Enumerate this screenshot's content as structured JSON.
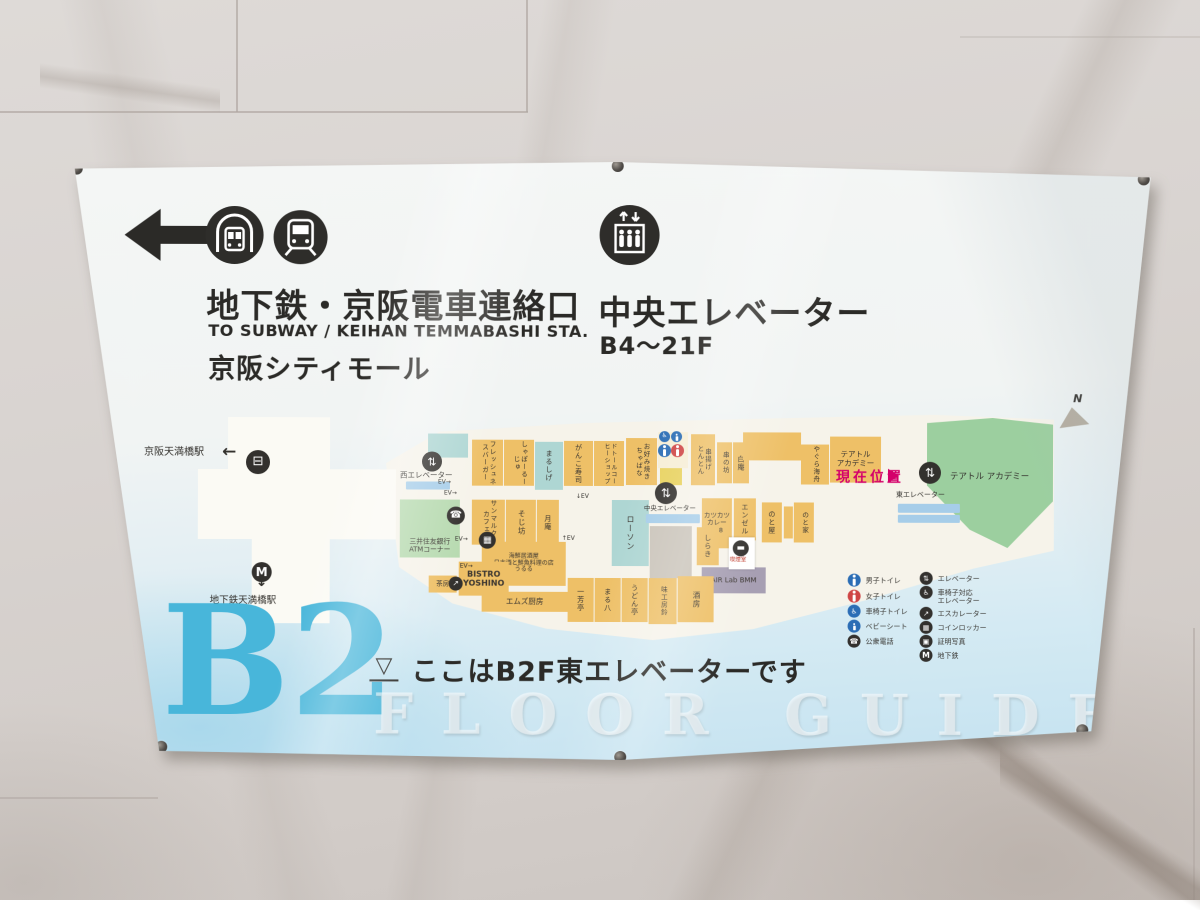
{
  "header": {
    "left": {
      "title": "地下鉄・京阪電車連絡口",
      "subtitle": "TO SUBWAY / KEIHAN TEMMABASHI STA.",
      "mall": "京阪シティモール"
    },
    "center": {
      "title": "中央エレベーター",
      "floors": "B4〜21F"
    }
  },
  "band": {
    "floor": "B2",
    "marker": "▽",
    "you_are_here": "ここはB2F東エレベーターです",
    "watermark": "FLOOR GUIDE"
  },
  "map": {
    "north_label": "N",
    "current_location": "現在位置",
    "colors": {
      "o": "#eec067",
      "t": "#aed6d3",
      "g": "#b7dab0",
      "G": "#9ccf9f",
      "gr": "#cac4ba",
      "p": "#a79fb3",
      "y": "#e8d25f",
      "c": "#f6eed6",
      "w": "#ffffff"
    },
    "corridors": [
      {
        "x": 158,
        "y": 258,
        "w": 70,
        "h": 54
      },
      {
        "x": 182,
        "y": 258,
        "w": 78,
        "h": 206
      },
      {
        "x": 128,
        "y": 310,
        "w": 198,
        "h": 70
      },
      {
        "x": 258,
        "y": 318,
        "w": 64,
        "h": 44
      }
    ],
    "blocks": [
      {
        "x": 402,
        "y": 280,
        "w": 31,
        "h": 46,
        "c": "o",
        "t": "フレッシュネスバーガー",
        "m": "v",
        "fs": 6.5,
        "n": "block-freshness-burger"
      },
      {
        "x": 434,
        "y": 280,
        "w": 30,
        "h": 46,
        "c": "o",
        "t": "しゃぽーるーじゅ",
        "m": "v",
        "fs": 6.5,
        "n": "block-chapeau-rouge"
      },
      {
        "x": 465,
        "y": 282,
        "w": 28,
        "h": 48,
        "c": "t",
        "t": "まるしげ",
        "m": "v",
        "fs": 7,
        "n": "block-marushige"
      },
      {
        "x": 494,
        "y": 281,
        "w": 29,
        "h": 45,
        "c": "o",
        "t": "がんこ寿司",
        "m": "v",
        "fs": 7,
        "n": "block-ganko-sushi"
      },
      {
        "x": 524,
        "y": 281,
        "w": 30,
        "h": 45,
        "c": "o",
        "t": "ドトールコーヒーショップ",
        "m": "v",
        "fs": 6,
        "n": "block-doutor-coffee"
      },
      {
        "x": 556,
        "y": 278,
        "w": 31,
        "h": 47,
        "c": "o",
        "t": "お好み焼き\nちゃばな",
        "m": "v",
        "fs": 6.5,
        "n": "block-okonomiyaki-chabana"
      },
      {
        "x": 588,
        "y": 272,
        "w": 30,
        "h": 36,
        "c": "c",
        "t": "",
        "n": "block-restroom-area"
      },
      {
        "x": 590,
        "y": 308,
        "w": 22,
        "h": 17,
        "c": "y",
        "t": "",
        "n": "block-service"
      },
      {
        "x": 621,
        "y": 274,
        "w": 24,
        "h": 51,
        "c": "o",
        "t": "串揚げ\nとんとん",
        "m": "v",
        "fs": 6.5,
        "n": "block-kushiage-tonton"
      },
      {
        "x": 647,
        "y": 282,
        "w": 15,
        "h": 41,
        "c": "o",
        "t": "串の坊",
        "m": "v",
        "fs": 6.5,
        "n": "block-kushinobo"
      },
      {
        "x": 663,
        "y": 282,
        "w": 16,
        "h": 41,
        "c": "o",
        "t": "白庵",
        "m": "v",
        "fs": 7,
        "n": "block-hakuan"
      },
      {
        "x": 673,
        "y": 272,
        "w": 58,
        "h": 28,
        "c": "o",
        "t": "",
        "n": "block-unlabeled-1"
      },
      {
        "x": 731,
        "y": 284,
        "w": 28,
        "h": 40,
        "c": "o",
        "t": "やぐら海舟",
        "m": "v",
        "fs": 6.5,
        "n": "block-yagura-kaishu"
      },
      {
        "x": 760,
        "y": 276,
        "w": 51,
        "h": 46,
        "c": "o",
        "t": "テアトル\nアカデミー",
        "m": "h",
        "fs": 7.5,
        "n": "block-theatre-academy-room"
      },
      {
        "x": 402,
        "y": 340,
        "w": 33,
        "h": 45,
        "c": "o",
        "t": "サンマルク・カフェ",
        "m": "v",
        "fs": 6.5,
        "n": "block-saint-marc-cafe"
      },
      {
        "x": 436,
        "y": 340,
        "w": 30,
        "h": 45,
        "c": "o",
        "t": "そじ坊",
        "m": "v",
        "fs": 7.5,
        "n": "block-sojibo"
      },
      {
        "x": 467,
        "y": 340,
        "w": 22,
        "h": 45,
        "c": "o",
        "t": "月庵",
        "m": "v",
        "fs": 7,
        "n": "block-tsukian"
      },
      {
        "x": 542,
        "y": 340,
        "w": 37,
        "h": 66,
        "c": "t",
        "t": "ローソン",
        "m": "v",
        "fs": 8,
        "n": "block-lawson"
      },
      {
        "x": 580,
        "y": 366,
        "w": 42,
        "h": 52,
        "c": "gr",
        "t": "",
        "n": "block-backroom"
      },
      {
        "x": 632,
        "y": 338,
        "w": 30,
        "h": 50,
        "c": "o",
        "t": "カツカツ\nカレー888",
        "m": "h",
        "fs": 6.5,
        "n": "block-katsukatsu-curry"
      },
      {
        "x": 664,
        "y": 338,
        "w": 22,
        "h": 42,
        "c": "o",
        "t": "エンゼル",
        "m": "v",
        "fs": 7,
        "n": "block-angel"
      },
      {
        "x": 692,
        "y": 342,
        "w": 20,
        "h": 40,
        "c": "o",
        "t": "のと屋",
        "m": "v",
        "fs": 7,
        "n": "block-notoya"
      },
      {
        "x": 714,
        "y": 346,
        "w": 9,
        "h": 32,
        "c": "o",
        "t": "",
        "n": "block-unlabeled-2"
      },
      {
        "x": 724,
        "y": 342,
        "w": 20,
        "h": 40,
        "c": "o",
        "t": "のと家",
        "m": "v",
        "fs": 6.5,
        "n": "block-notoke"
      },
      {
        "x": 627,
        "y": 367,
        "w": 22,
        "h": 38,
        "c": "o",
        "t": "しらき",
        "m": "v",
        "fs": 7,
        "n": "block-shiraki"
      },
      {
        "x": 632,
        "y": 407,
        "w": 64,
        "h": 26,
        "c": "p",
        "t": "AIR Lab BMM",
        "m": "h",
        "fs": 7,
        "n": "block-air-lab"
      },
      {
        "x": 412,
        "y": 382,
        "w": 84,
        "h": 44,
        "c": "o",
        "t": "海鮮居酒屋\n日本酒と鮮魚料理の店\nうるる",
        "m": "h",
        "fs": 6,
        "n": "block-ururu"
      },
      {
        "x": 389,
        "y": 402,
        "w": 50,
        "h": 34,
        "c": "o",
        "t": "BISTRO\nYOSHINO",
        "m": "h",
        "fs": 8,
        "b": 1,
        "n": "block-bistro-yoshino"
      },
      {
        "x": 359,
        "y": 416,
        "w": 28,
        "h": 17,
        "c": "o",
        "t": "茶房",
        "m": "h",
        "fs": 6.5,
        "n": "block-sabo"
      },
      {
        "x": 412,
        "y": 432,
        "w": 86,
        "h": 20,
        "c": "o",
        "t": "エムズ厨房",
        "m": "h",
        "fs": 7.5,
        "n": "block-ms-kitchen"
      },
      {
        "x": 498,
        "y": 418,
        "w": 26,
        "h": 44,
        "c": "o",
        "t": "一芳亭",
        "m": "v",
        "fs": 7,
        "n": "block-ippotei"
      },
      {
        "x": 525,
        "y": 418,
        "w": 26,
        "h": 44,
        "c": "o",
        "t": "まる八",
        "m": "v",
        "fs": 7,
        "n": "block-maruhachi"
      },
      {
        "x": 552,
        "y": 418,
        "w": 26,
        "h": 44,
        "c": "o",
        "t": "うどん亭",
        "m": "v",
        "fs": 7,
        "n": "block-udontei"
      },
      {
        "x": 579,
        "y": 418,
        "w": 28,
        "h": 46,
        "c": "o",
        "t": "味工房鈴",
        "m": "v",
        "fs": 6.5,
        "n": "block-ajikobo-suzu"
      },
      {
        "x": 608,
        "y": 416,
        "w": 36,
        "h": 46,
        "c": "o",
        "t": "酒房",
        "m": "v",
        "fs": 7.5,
        "n": "block-shubo"
      },
      {
        "x": 358,
        "y": 274,
        "w": 40,
        "h": 24,
        "c": "t",
        "t": "",
        "n": "block-unlabeled-3"
      },
      {
        "x": 330,
        "y": 340,
        "w": 60,
        "h": 58,
        "c": "g",
        "t": "三井住友銀行\nATMコーナー",
        "m": "h",
        "fs": 6.8,
        "va": "end",
        "n": "block-smbc-atm"
      },
      {
        "x": 659,
        "y": 377,
        "w": 26,
        "h": 32,
        "c": "w",
        "t": "",
        "n": "block-smoking-room"
      }
    ],
    "icons": [
      {
        "x": 176,
        "y": 291,
        "d": 24,
        "bg": "#33312e",
        "g": "train",
        "n": "keihan-station-icon"
      },
      {
        "x": 182,
        "y": 403,
        "d": 20,
        "bg": "#33312e",
        "g": "subway",
        "n": "subway-station-icon"
      },
      {
        "x": 352,
        "y": 292,
        "d": 20,
        "bg": "#33312e",
        "g": "ev",
        "n": "west-elevator-icon"
      },
      {
        "x": 377,
        "y": 347,
        "d": 18,
        "bg": "#33312e",
        "g": "phone",
        "n": "public-phone-icon"
      },
      {
        "x": 585,
        "y": 322,
        "d": 22,
        "bg": "#33312e",
        "g": "ev",
        "n": "central-elevator-icon"
      },
      {
        "x": 849,
        "y": 301,
        "d": 22,
        "bg": "#33312e",
        "g": "ev",
        "n": "east-elevator-icon"
      },
      {
        "x": 409,
        "y": 372,
        "d": 17,
        "bg": "#33312e",
        "g": "locker",
        "n": "coin-locker-icon"
      },
      {
        "x": 379,
        "y": 417,
        "d": 14,
        "bg": "#33312e",
        "g": "esc",
        "n": "escalator-icon"
      },
      {
        "x": 589,
        "y": 271,
        "d": 11,
        "bg": "#2b6db5",
        "g": "wheel",
        "n": "wheelchair-toilet-icon"
      },
      {
        "x": 601,
        "y": 271,
        "d": 11,
        "bg": "#2b6db5",
        "g": "baby",
        "n": "baby-seat-icon"
      },
      {
        "x": 588,
        "y": 284,
        "d": 13,
        "bg": "#2b6db5",
        "g": "male",
        "n": "mens-toilet-icon"
      },
      {
        "x": 601,
        "y": 284,
        "d": 13,
        "bg": "#cf4545",
        "g": "female",
        "n": "womens-toilet-icon"
      },
      {
        "x": 663,
        "y": 380,
        "d": 16,
        "bg": "#33312e",
        "g": "smoke",
        "n": "smoking-icon"
      }
    ],
    "strips": [
      {
        "x": 336,
        "y": 322,
        "w": 44,
        "h": 8
      },
      {
        "x": 576,
        "y": 354,
        "w": 54,
        "h": 9
      },
      {
        "x": 828,
        "y": 343,
        "w": 62,
        "h": 9
      },
      {
        "x": 828,
        "y": 354,
        "w": 62,
        "h": 8
      }
    ],
    "texts": [
      {
        "x": 74,
        "y": 288,
        "t": "京阪天満橋駅",
        "fs": 10
      },
      {
        "x": 152,
        "y": 284,
        "t": "←",
        "fs": 17,
        "b": 1
      },
      {
        "x": 140,
        "y": 437,
        "t": "地下鉄天満橋駅",
        "fs": 9.5
      },
      {
        "x": 186,
        "y": 416,
        "t": "↓",
        "fs": 14,
        "b": 1
      },
      {
        "x": 330,
        "y": 312,
        "t": "西エレベーター",
        "fs": 7.5
      },
      {
        "x": 574,
        "y": 345,
        "t": "中央エレベーター",
        "fs": 6.5
      },
      {
        "x": 826,
        "y": 331,
        "t": "東エレベーター",
        "fs": 7
      },
      {
        "x": 766,
        "y": 310,
        "t": "現在位置",
        "fs": 14,
        "c": "#d4006a",
        "b": 1,
        "ls": 3
      },
      {
        "x": 880,
        "y": 312,
        "t": "テアトル アカデミー",
        "fs": 8.5
      },
      {
        "x": 1003,
        "y": 232,
        "t": "N",
        "fs": 11,
        "b": 1,
        "i": 1
      },
      {
        "x": 368,
        "y": 320,
        "t": "EV→",
        "fs": 6
      },
      {
        "x": 374,
        "y": 331,
        "t": "EV→",
        "fs": 6
      },
      {
        "x": 385,
        "y": 377,
        "t": "EV→",
        "fs": 6
      },
      {
        "x": 390,
        "y": 404,
        "t": "EV→",
        "fs": 6
      },
      {
        "x": 506,
        "y": 334,
        "t": "↓EV",
        "fs": 6
      },
      {
        "x": 492,
        "y": 376,
        "t": "↑EV",
        "fs": 6
      },
      {
        "x": 660,
        "y": 397,
        "t": "喫煙室",
        "fs": 5.5,
        "c": "#c03a2b"
      }
    ]
  },
  "legend": {
    "left": [
      {
        "label": "男子トイレ",
        "color": "#2b6db5",
        "glyph": "male"
      },
      {
        "label": "女子トイレ",
        "color": "#cf4545",
        "glyph": "female"
      },
      {
        "label": "車椅子トイレ",
        "color": "#2b6db5",
        "glyph": "wheel"
      },
      {
        "label": "ベビーシート",
        "color": "#2b6db5",
        "glyph": "baby"
      },
      {
        "label": "公衆電話",
        "color": "#33312e",
        "glyph": "phone"
      }
    ],
    "right": [
      {
        "label": "エレベーター",
        "color": "#33312e",
        "glyph": "ev"
      },
      {
        "label": "車椅子対応\nエレベーター",
        "color": "#33312e",
        "glyph": "wheel"
      },
      {
        "label": "エスカレーター",
        "color": "#33312e",
        "glyph": "esc"
      },
      {
        "label": "コインロッカー",
        "color": "#33312e",
        "glyph": "locker"
      },
      {
        "label": "証明写真",
        "color": "#33312e",
        "glyph": "photo"
      },
      {
        "label": "地下鉄",
        "color": "#33312e",
        "glyph": "subway"
      }
    ]
  }
}
